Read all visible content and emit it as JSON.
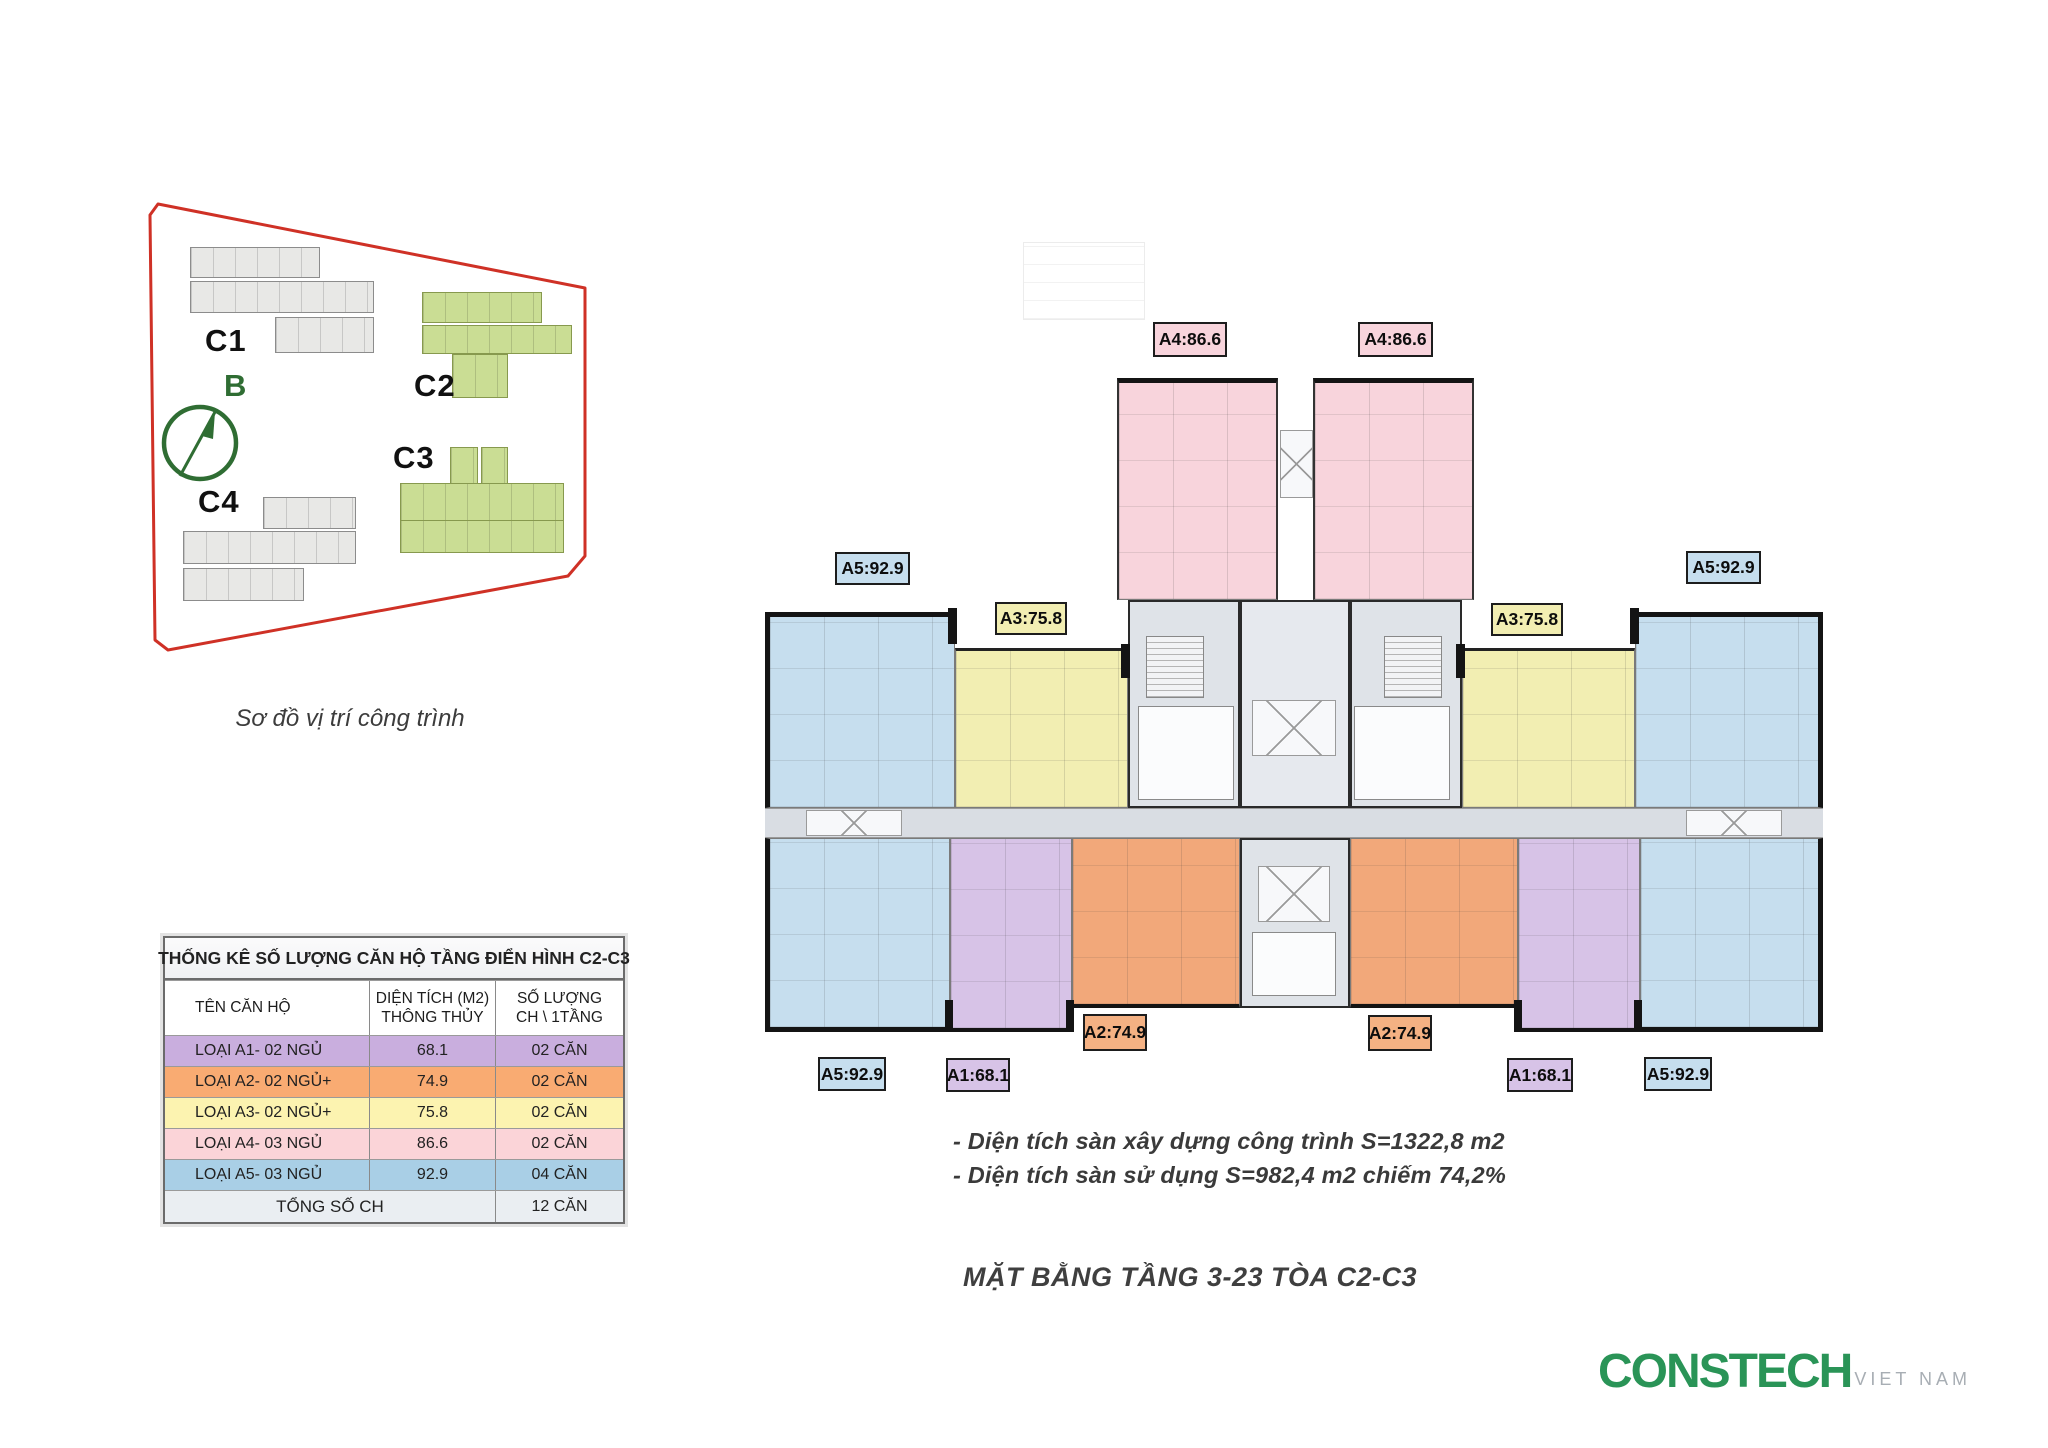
{
  "site_plan": {
    "caption": "Sơ đồ vị trí công trình",
    "compass_label": "B",
    "building_labels": {
      "c1": "C1",
      "c2": "C2",
      "c3": "C3",
      "c4": "C4"
    }
  },
  "stats_table": {
    "title": "THỐNG KÊ SỐ LƯỢNG CĂN HỘ TẦNG ĐIỂN HÌNH C2-C3",
    "columns": {
      "c1": "TÊN CĂN HỘ",
      "c2a": "DIỆN TÍCH (M2)",
      "c2b": "THÔNG THỦY",
      "c3a": "SỐ LƯỢNG",
      "c3b": "CH \\ 1TẦNG"
    },
    "rows": [
      {
        "name": "LOẠI A1- 02 NGỦ",
        "area": "68.1",
        "count": "02 CĂN"
      },
      {
        "name": "LOẠI A2- 02 NGỦ+",
        "area": "74.9",
        "count": "02 CĂN"
      },
      {
        "name": "LOẠI A3- 02 NGỦ+",
        "area": "75.8",
        "count": "02 CĂN"
      },
      {
        "name": "LOẠI A4- 03 NGỦ",
        "area": "86.6",
        "count": "02 CĂN"
      },
      {
        "name": "LOẠI A5- 03 NGỦ",
        "area": "92.9",
        "count": "04 CĂN"
      }
    ],
    "total": {
      "label": "TỔNG SỐ CH",
      "count": "12 CĂN"
    }
  },
  "floor_plan": {
    "unit_labels": {
      "a1": "A1:68.1",
      "a2": "A2:74.9",
      "a3": "A3:75.8",
      "a4": "A4:86.6",
      "a5": "A5:92.9"
    },
    "notes": {
      "line1": "- Diện tích sàn xây dựng công trình S=1322,8 m2",
      "line2": "- Diện tích sàn sử dụng S=982,4 m2 chiếm 74,2%"
    },
    "title": "MẶT BẰNG TẦNG 3-23 TÒA C2-C3"
  },
  "logo": {
    "brand": "CONSTECH",
    "region": "VIET NAM"
  },
  "colors": {
    "boundary_red": "#cf3126",
    "site_green": "#cadd94",
    "site_gray": "#e8e8e6",
    "unit_blue": "#c6deee",
    "unit_yellow": "#f2eeb2",
    "unit_pink": "#f8d4dc",
    "unit_purple": "#d7c3e7",
    "unit_orange": "#f2a87a",
    "corridor_gray": "#d9dde3",
    "logo_green": "#2a9457"
  }
}
